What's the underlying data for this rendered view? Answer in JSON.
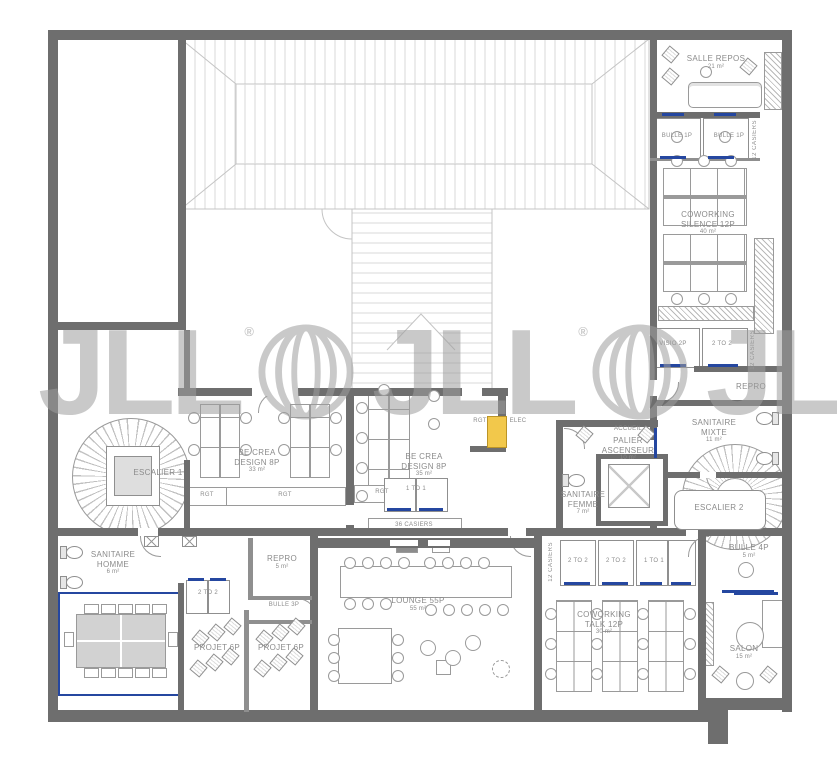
{
  "watermark": {
    "brand": "JLL",
    "registered": "®",
    "partial": "J"
  },
  "colors": {
    "wall": "#6e6e6e",
    "line": "#9a9a9a",
    "roof_line": "#c4c4c4",
    "text": "#8b8b8b",
    "accent_blue": "#2547a0",
    "highlight_yellow": "#f2c84b",
    "watermark_grey": "#9e9e9e",
    "meeting_table_grey": "#d2d2d2"
  },
  "labels": {
    "salle_repos": {
      "line1": "SALLE REPOS",
      "area": "21 m²"
    },
    "bulle_1p_left": {
      "line1": "BULLE 1P"
    },
    "bulle_1p_right": {
      "line1": "BULLE 1P"
    },
    "casiers_12_a": {
      "line1": "12 CASIERS"
    },
    "coworking_silence": {
      "line1": "COWORKING",
      "line2": "SILENCE 12P",
      "area": "40 m²"
    },
    "visio_2p": {
      "line1": "VISIO 2P"
    },
    "two_to_two_a": {
      "line1": "2 TO 2"
    },
    "casiers_12_b": {
      "line1": "12 CASIERS"
    },
    "repro_right": {
      "line1": "REPRO"
    },
    "sanitaire_mixte": {
      "line1": "SANITAIRE",
      "line2": "MIXTE",
      "area": "11 m²"
    },
    "accueil": {
      "line1": "ACCUEIL"
    },
    "palier_ascenseur": {
      "line1": "PALIER",
      "line2": "ASCENSEUR",
      "area": "10 m²"
    },
    "sanitaire_femme": {
      "line1": "SANITAIRE",
      "line2": "FEMME",
      "area": "7 m²"
    },
    "escalier_2": {
      "line1": "ESCALIER 2"
    },
    "escalier_1": {
      "line1": "ESCALIER 1"
    },
    "be_crea_design_a": {
      "line1": "BE CREA",
      "line2": "DESIGN 8P",
      "area": "33 m²"
    },
    "be_crea_design_b": {
      "line1": "BE CREA",
      "line2": "DESIGN 8P",
      "area": "35 m²"
    },
    "rgt_a": {
      "line1": "RGT"
    },
    "rgt_b": {
      "line1": "RGT"
    },
    "rgt_c": {
      "line1": "RGT"
    },
    "rgt_d": {
      "line1": "RGT"
    },
    "elec": {
      "line1": "ELEC"
    },
    "one_to_one_a": {
      "line1": "1 TO 1"
    },
    "casiers_36": {
      "line1": "36 CASIERS"
    },
    "lounge": {
      "line1": "LOUNGE 55P",
      "area": "55 m²"
    },
    "sanitaire_homme": {
      "line1": "SANITAIRE",
      "line2": "HOMME",
      "area": "6 m²"
    },
    "repro_left": {
      "line1": "REPRO",
      "area": "5 m²"
    },
    "bulle_3p": {
      "line1": "BULLE 3P"
    },
    "two_to_two_b": {
      "line1": "2 TO 2"
    },
    "projet_6p_a": {
      "line1": "PROJET 6P"
    },
    "projet_6p_b": {
      "line1": "PROJET 6P"
    },
    "two_to_two_c": {
      "line1": "2 TO 2"
    },
    "two_to_two_d": {
      "line1": "2 TO 2"
    },
    "one_to_one_b": {
      "line1": "1 TO 1"
    },
    "casiers_12_c": {
      "line1": "12 CASIERS"
    },
    "coworking_talk": {
      "line1": "COWORKING",
      "line2": "TALK 12P",
      "area": "30 m²"
    },
    "bulle_4p": {
      "line1": "BULLE 4P",
      "area": "5 m²"
    },
    "salon": {
      "line1": "SALON",
      "area": "15 m²"
    }
  }
}
